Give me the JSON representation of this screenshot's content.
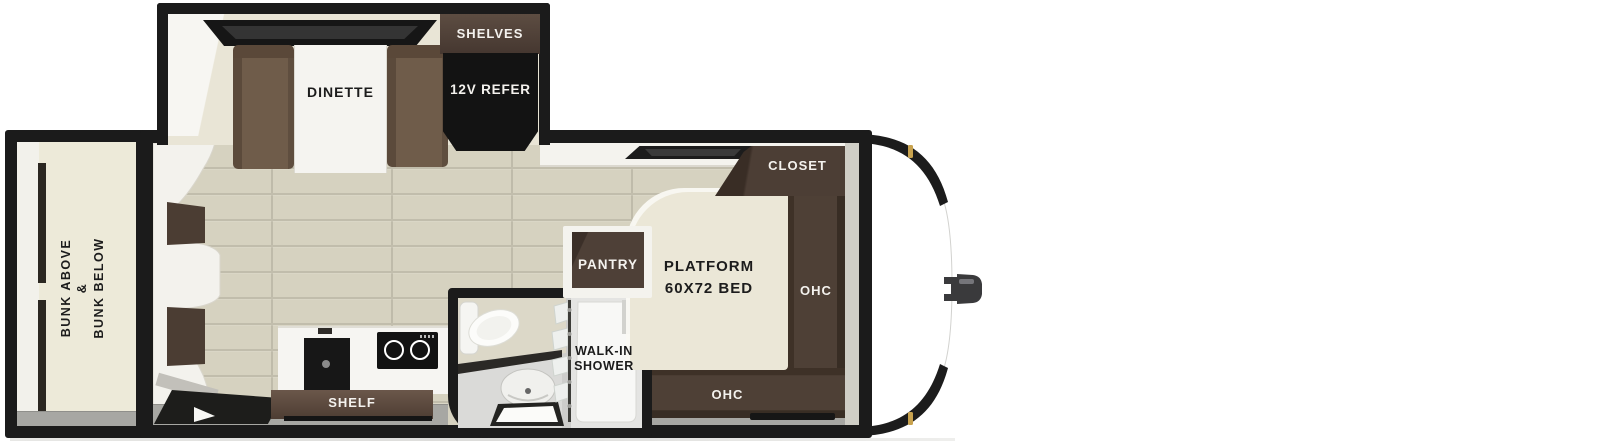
{
  "floorplan": {
    "labels": {
      "dinette": "DINETTE",
      "shelves": "SHELVES",
      "refrigerator": "12V REFER",
      "bunk_line1": "BUNK ABOVE",
      "bunk_line2": "&",
      "bunk_line3": "BUNK BELOW",
      "closet": "CLOSET",
      "pantry": "PANTRY",
      "bed_line1": "PLATFORM",
      "bed_line2": "60X72 BED",
      "ohc_right": "OHC",
      "ohc_bottom": "OHC",
      "shower_line1": "WALK-IN",
      "shower_line2": "SHOWER",
      "shelf": "SHELF"
    },
    "colors": {
      "wall_outline": "#1b1b1b",
      "wood_floor": "#d6d2c0",
      "plank_line": "#c1bdac",
      "cream_surface": "#ebe7d7",
      "dark_cabinet": "#4e4036",
      "bench_brown": "#6f5c4a",
      "refrigerator_black": "#131313",
      "bath_floor": "#cdcdcb",
      "gray_strip": "#a7a7a3",
      "marker_light": "#c8a24e"
    }
  }
}
